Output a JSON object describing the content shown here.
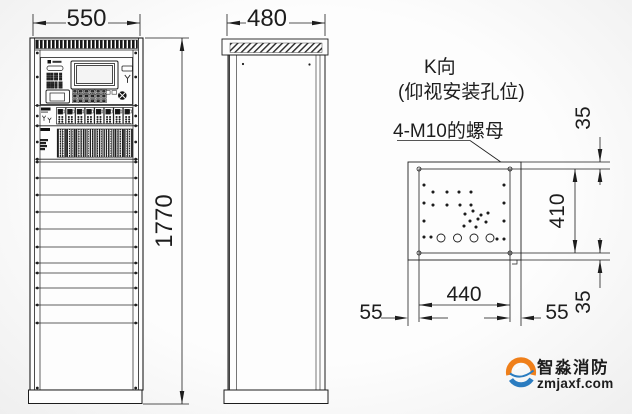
{
  "front_view": {
    "width_dim": "550",
    "height_dim": "1770"
  },
  "side_view": {
    "depth_dim": "480"
  },
  "k_view": {
    "title": "K向",
    "subtitle": "(仰视安装孔位)",
    "nut_label": "4-M10的螺母",
    "height_dim": "410",
    "width_dim": "440",
    "top_margin_dim": "35",
    "bottom_margin_dim": "35",
    "left_margin_dim": "55",
    "right_margin_dim": "55"
  },
  "watermark": {
    "brand": "智淼消防",
    "site": "zmjaxf.com"
  },
  "colors": {
    "line": "#1d1d1d",
    "watermark_orange": "#ef7f1a",
    "watermark_blue": "#2b7cc0",
    "watermark_text": "#5c6164"
  }
}
